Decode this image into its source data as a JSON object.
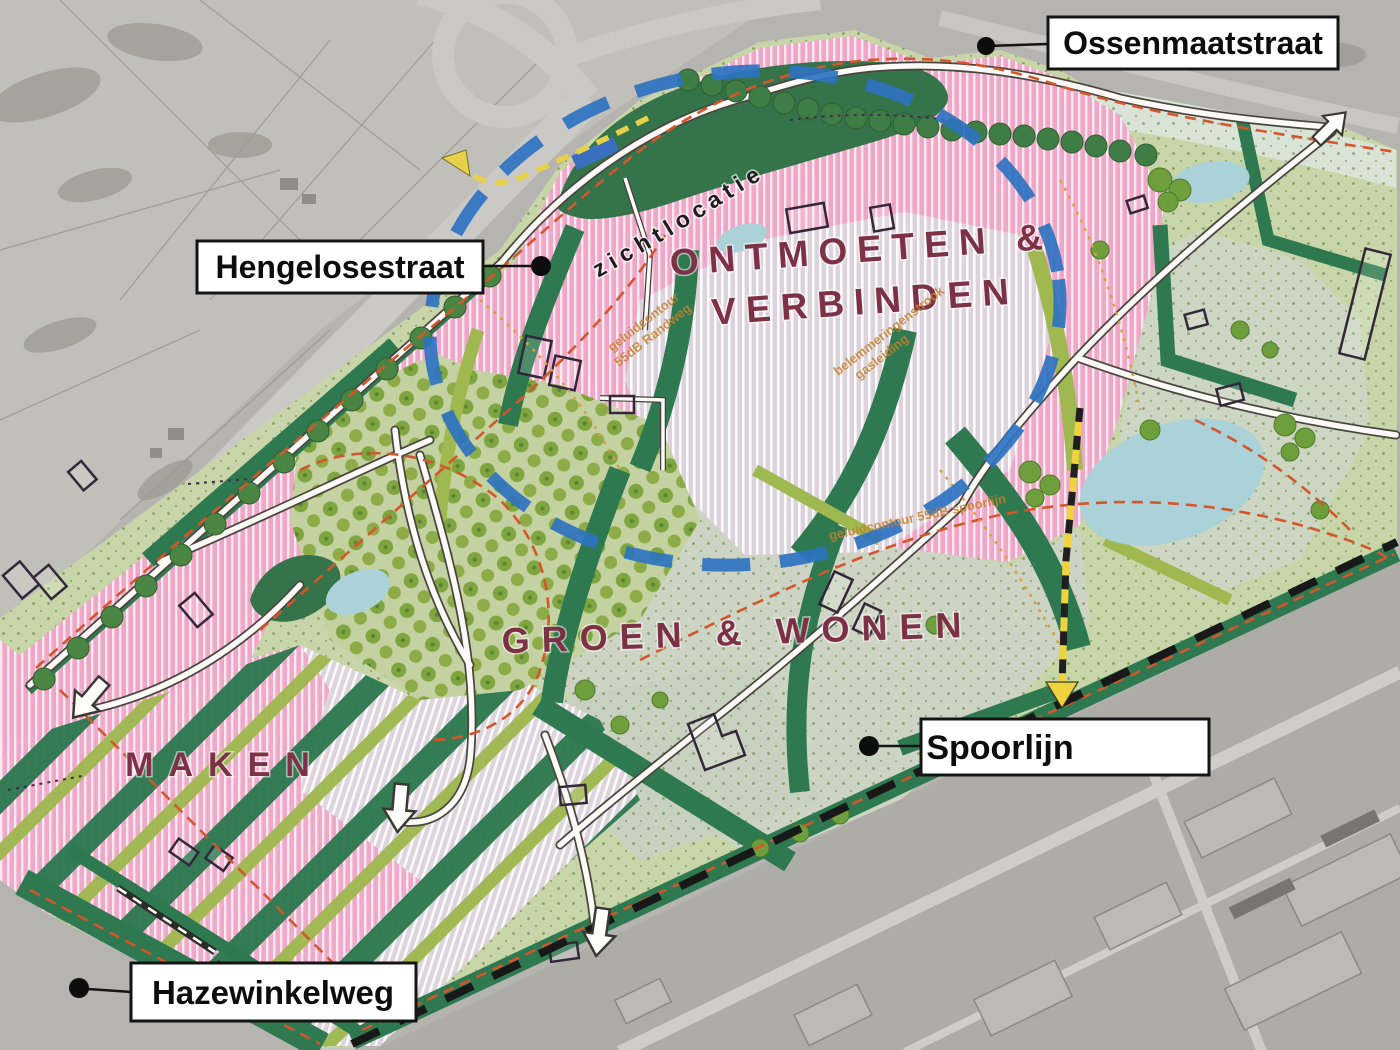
{
  "map": {
    "street_labels": {
      "ossenmaatstraat": "Ossenmaatstraat",
      "hengelosestraat": "Hengelosestraat",
      "spoorlijn": "Spoorlijn",
      "hazewinkelweg": "Hazewinkelweg"
    },
    "zones": {
      "ontmoeten_line1": "ONTMOETEN &",
      "ontmoeten_line2": "VERBINDEN",
      "groen_wonen": "GROEN & WONEN",
      "maken": "MAKEN"
    },
    "annotations": {
      "zichtlocatie": "zichtlocatie",
      "geluidcontour_randweg": {
        "line1": "geluidcontour",
        "line2": "55dB Randweg"
      },
      "belemmeringenstrook": {
        "line1": "belemmeringenstrook",
        "line2": "gasleiding"
      },
      "geluidcontour_spoorlijn": "geluidcontour 55dB spoorlijn"
    },
    "colors": {
      "plan_green": "#c7d5a8",
      "pink_zone": "#f0a6c7",
      "lilac_hatch": "#ddd3dd",
      "dark_green": "#2e7950",
      "olive": "#9fb850",
      "water": "#aad2d8",
      "route_blue": "#2e73c1",
      "contour_orange": "#d4562c",
      "zone_text": "#7c3146",
      "railway_black": "#181818",
      "arrow_yellow": "#e6d24a",
      "aerial_grey": "#b6b4b0"
    }
  }
}
